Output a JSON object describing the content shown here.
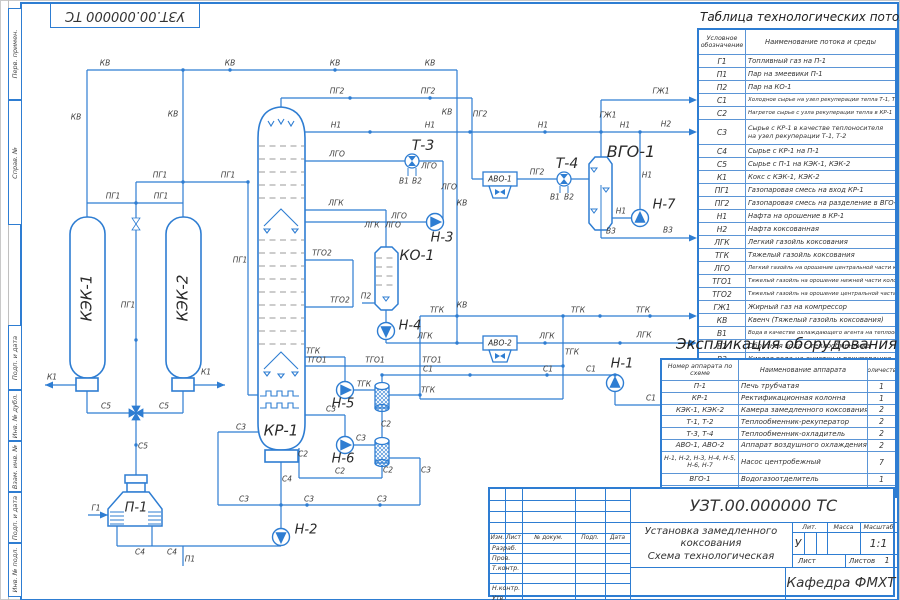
{
  "colors": {
    "accent": "#2e7dd2",
    "ink": "#3a3a3a"
  },
  "corner_stamp": "УЗТ.00.000000 ТС",
  "margin": {
    "labels": [
      "Перв. примен.",
      "Справ. №",
      "Подп. и дата",
      "Инв. № дубл.",
      "Взам. инв. №",
      "Подп. и дата",
      "Инв. № подл."
    ]
  },
  "flow_table": {
    "title": "Таблица технологических потоков",
    "col1": "Условное обозначение",
    "col2": "Наименование потока и среды",
    "rows": [
      [
        "Г1",
        "Топливный газ на П-1"
      ],
      [
        "П1",
        "Пар на змеевики  П-1"
      ],
      [
        "П2",
        "Пар на КО-1"
      ],
      [
        "С1",
        "Холодное сырье на узел рекуперации тепла Т-1, Т-2"
      ],
      [
        "С2",
        "Нагретое сырье с узла рекуперации тепла в КР-1"
      ],
      [
        "С3",
        "Сырье с КР-1 в качестве теплоносителя на узел рекуперации Т-1, Т-2"
      ],
      [
        "С4",
        "Сырье с КР-1 на  П-1"
      ],
      [
        "С5",
        "Сырье с П-1 на КЭК-1, КЭК-2"
      ],
      [
        "К1",
        "Кокс с КЭК-1, КЭК-2"
      ],
      [
        "ПГ1",
        "Газопаровая смесь на вход КР-1"
      ],
      [
        "ПГ2",
        "Газопаровая смесь на разделение в ВГО-1"
      ],
      [
        "Н1",
        "Нафта на орошение в КР-1"
      ],
      [
        "Н2",
        "Нафта коксованная"
      ],
      [
        "ЛГК",
        "Легкий газойль коксования"
      ],
      [
        "ТГК",
        "Тяжелый газойль коксования"
      ],
      [
        "ЛГО",
        "Легкий газойль на орошение центральной части колонны КР-1"
      ],
      [
        "ТГО1",
        "Тяжелый газойль на орошение нижней части колонны КР-1"
      ],
      [
        "ТГО2",
        "Тяжелый газойль на орошение центральной части колонны КР-1"
      ],
      [
        "ГЖ1",
        "Жирный газ на компрессор"
      ],
      [
        "КВ",
        "Квенч (Тяжелый газойль коксования)"
      ],
      [
        "В1",
        "Вода в качестве охлаждающего агента на теплообменник"
      ],
      [
        "В2",
        "Обратная вода с теплообменника"
      ],
      [
        "В3",
        "Кислая вода на очистку и рекуперацию"
      ]
    ]
  },
  "equipment_table": {
    "title": "Экспликация оборудования",
    "col1": "Номер аппарата по схеме",
    "col2": "Наименование аппарата",
    "col3": "Количество",
    "rows": [
      [
        "П-1",
        "Печь трубчатая",
        "1"
      ],
      [
        "КР-1",
        "Ректификационная колонна",
        "1"
      ],
      [
        "КЭК-1, КЭК-2",
        "Камера замедленного коксования",
        "2"
      ],
      [
        "Т-1, Т-2",
        "Теплообменник-рекуператор",
        "2"
      ],
      [
        "Т-3, Т-4",
        "Теплообменник-охладитель",
        "2"
      ],
      [
        "АВО-1, АВО-2",
        "Аппарат воздушного охлаждения",
        "2"
      ],
      [
        "Н-1, Н-2, Н-3, Н-4, Н-5, Н-6, Н-7",
        "Насос центробежный",
        "7"
      ],
      [
        "ВГО-1",
        "Водогазоотделитель",
        "1"
      ],
      [
        "КО-1",
        "Колонна отпарная",
        "1"
      ]
    ]
  },
  "title_block": {
    "code": "УЗТ.00.000000 ТС",
    "doc_title_lines": "Установка замедленного\nкоксования\nСхема технологическая",
    "lit_label": "Лит.",
    "mass_label": "Масса",
    "scale_label": "Масштаб",
    "lit": "У",
    "scale": "1:1",
    "sheet_label": "Лист",
    "sheets_label": "Листов",
    "sheets": "1",
    "department": "Кафедра ФМХТ",
    "header_cells": [
      "Изм.",
      "Лист",
      "№ докум.",
      "Подп.",
      "Дата"
    ],
    "sig_rows": [
      "Разраб.",
      "Пров.",
      "Т.контр.",
      "",
      "Н.контр.",
      "Утв."
    ]
  },
  "diagram": {
    "equipment": [
      {
        "t": "КЭК-1",
        "x": 87,
        "y": 298,
        "rot": -90,
        "s": 15
      },
      {
        "t": "КЭК-2",
        "x": 183,
        "y": 298,
        "rot": -90,
        "s": 15
      },
      {
        "t": "КР-1",
        "x": 281,
        "y": 431,
        "s": 15
      },
      {
        "t": "П-1",
        "x": 136,
        "y": 508,
        "s": 13
      },
      {
        "t": "Т-3",
        "x": 423,
        "y": 146,
        "s": 14
      },
      {
        "t": "Т-4",
        "x": 567,
        "y": 164,
        "s": 14
      },
      {
        "t": "АВО-1",
        "x": 500,
        "y": 179,
        "s": 7.5
      },
      {
        "t": "АВО-2",
        "x": 500,
        "y": 343,
        "s": 7.5
      },
      {
        "t": "ВГО-1",
        "x": 631,
        "y": 152,
        "s": 16
      },
      {
        "t": "КО-1",
        "x": 417,
        "y": 256,
        "s": 14
      },
      {
        "t": "Н-1",
        "x": 622,
        "y": 364,
        "s": 13
      },
      {
        "t": "Н-2",
        "x": 306,
        "y": 530,
        "s": 13
      },
      {
        "t": "Н-3",
        "x": 442,
        "y": 238,
        "s": 13
      },
      {
        "t": "Н-4",
        "x": 410,
        "y": 326,
        "s": 13
      },
      {
        "t": "Н-5",
        "x": 343,
        "y": 404,
        "s": 13
      },
      {
        "t": "Н-6",
        "x": 343,
        "y": 459,
        "s": 13
      },
      {
        "t": "Н-7",
        "x": 664,
        "y": 205,
        "s": 13
      }
    ],
    "lines": [
      {
        "t": "КВ",
        "x": 105,
        "y": 63
      },
      {
        "t": "КВ",
        "x": 230,
        "y": 63
      },
      {
        "t": "КВ",
        "x": 335,
        "y": 63
      },
      {
        "t": "КВ",
        "x": 430,
        "y": 63
      },
      {
        "t": "КВ",
        "x": 76,
        "y": 117
      },
      {
        "t": "КВ",
        "x": 173,
        "y": 114
      },
      {
        "t": "КВ",
        "x": 447,
        "y": 112
      },
      {
        "t": "КВ",
        "x": 462,
        "y": 203
      },
      {
        "t": "КВ",
        "x": 462,
        "y": 305
      },
      {
        "t": "ПГ1",
        "x": 113,
        "y": 196
      },
      {
        "t": "ПГ1",
        "x": 161,
        "y": 196
      },
      {
        "t": "ПГ1",
        "x": 160,
        "y": 175
      },
      {
        "t": "ПГ1",
        "x": 228,
        "y": 175
      },
      {
        "t": "ПГ1",
        "x": 128,
        "y": 305
      },
      {
        "t": "ПГ1",
        "x": 240,
        "y": 260
      },
      {
        "t": "ПГ2",
        "x": 337,
        "y": 91
      },
      {
        "t": "ПГ2",
        "x": 428,
        "y": 91
      },
      {
        "t": "ПГ2",
        "x": 480,
        "y": 114
      },
      {
        "t": "ПГ2",
        "x": 537,
        "y": 172
      },
      {
        "t": "Н1",
        "x": 336,
        "y": 125
      },
      {
        "t": "Н1",
        "x": 430,
        "y": 125
      },
      {
        "t": "Н1",
        "x": 543,
        "y": 125
      },
      {
        "t": "Н1",
        "x": 625,
        "y": 125
      },
      {
        "t": "Н1",
        "x": 621,
        "y": 211
      },
      {
        "t": "Н1",
        "x": 647,
        "y": 175
      },
      {
        "t": "Н2",
        "x": 666,
        "y": 124
      },
      {
        "t": "ГЖ1",
        "x": 608,
        "y": 115
      },
      {
        "t": "ГЖ1",
        "x": 661,
        "y": 91
      },
      {
        "t": "В3",
        "x": 611,
        "y": 231
      },
      {
        "t": "В3",
        "x": 668,
        "y": 230
      },
      {
        "t": "В1",
        "x": 404,
        "y": 181
      },
      {
        "t": "В2",
        "x": 417,
        "y": 181
      },
      {
        "t": "В1",
        "x": 555,
        "y": 197
      },
      {
        "t": "В2",
        "x": 569,
        "y": 197
      },
      {
        "t": "ЛГО",
        "x": 337,
        "y": 154
      },
      {
        "t": "ЛГО",
        "x": 429,
        "y": 166
      },
      {
        "t": "ЛГО",
        "x": 449,
        "y": 187
      },
      {
        "t": "ЛГО",
        "x": 399,
        "y": 216
      },
      {
        "t": "ЛГО",
        "x": 393,
        "y": 225
      },
      {
        "t": "ЛГК",
        "x": 336,
        "y": 203
      },
      {
        "t": "ЛГК",
        "x": 372,
        "y": 225
      },
      {
        "t": "ЛГК",
        "x": 425,
        "y": 336
      },
      {
        "t": "ЛГК",
        "x": 547,
        "y": 336
      },
      {
        "t": "ЛГК",
        "x": 644,
        "y": 335
      },
      {
        "t": "ТГК",
        "x": 313,
        "y": 351
      },
      {
        "t": "ТГК",
        "x": 364,
        "y": 384
      },
      {
        "t": "ТГК",
        "x": 428,
        "y": 390
      },
      {
        "t": "ТГК",
        "x": 437,
        "y": 310
      },
      {
        "t": "ТГК",
        "x": 578,
        "y": 310
      },
      {
        "t": "ТГК",
        "x": 643,
        "y": 310
      },
      {
        "t": "ТГК",
        "x": 572,
        "y": 352
      },
      {
        "t": "ТГО1",
        "x": 317,
        "y": 360
      },
      {
        "t": "ТГО1",
        "x": 375,
        "y": 360
      },
      {
        "t": "ТГО1",
        "x": 432,
        "y": 360
      },
      {
        "t": "ТГО2",
        "x": 322,
        "y": 253
      },
      {
        "t": "ТГО2",
        "x": 340,
        "y": 300
      },
      {
        "t": "С1",
        "x": 428,
        "y": 369
      },
      {
        "t": "С1",
        "x": 548,
        "y": 369
      },
      {
        "t": "С1",
        "x": 591,
        "y": 369
      },
      {
        "t": "С1",
        "x": 651,
        "y": 398
      },
      {
        "t": "С2",
        "x": 386,
        "y": 424
      },
      {
        "t": "С2",
        "x": 303,
        "y": 454
      },
      {
        "t": "С2",
        "x": 340,
        "y": 471
      },
      {
        "t": "С2",
        "x": 388,
        "y": 470
      },
      {
        "t": "С3",
        "x": 331,
        "y": 409
      },
      {
        "t": "С3",
        "x": 361,
        "y": 438
      },
      {
        "t": "С3",
        "x": 426,
        "y": 470
      },
      {
        "t": "С3",
        "x": 241,
        "y": 427
      },
      {
        "t": "С3",
        "x": 244,
        "y": 499
      },
      {
        "t": "С3",
        "x": 309,
        "y": 499
      },
      {
        "t": "С3",
        "x": 382,
        "y": 499
      },
      {
        "t": "С4",
        "x": 287,
        "y": 479
      },
      {
        "t": "С4",
        "x": 140,
        "y": 552
      },
      {
        "t": "С4",
        "x": 172,
        "y": 552
      },
      {
        "t": "С5",
        "x": 106,
        "y": 406
      },
      {
        "t": "С5",
        "x": 164,
        "y": 406
      },
      {
        "t": "С5",
        "x": 143,
        "y": 446
      },
      {
        "t": "К1",
        "x": 52,
        "y": 377
      },
      {
        "t": "К1",
        "x": 206,
        "y": 372
      },
      {
        "t": "П1",
        "x": 190,
        "y": 559
      },
      {
        "t": "П2",
        "x": 366,
        "y": 296
      },
      {
        "t": "Г1",
        "x": 96,
        "y": 508
      }
    ]
  }
}
